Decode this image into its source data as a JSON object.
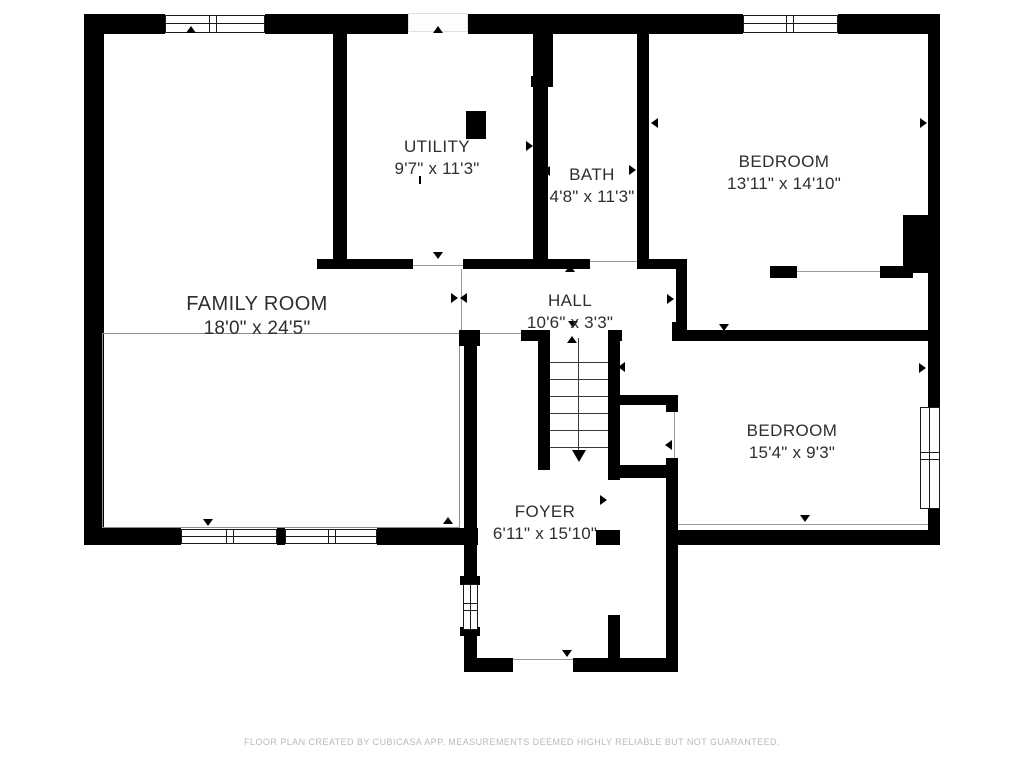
{
  "floorplan": {
    "rooms": [
      {
        "id": "utility",
        "label": "UTILITY",
        "dims": "9'7\" x 11'3\""
      },
      {
        "id": "bath",
        "label": "BATH",
        "dims": "4'8\" x 11'3\""
      },
      {
        "id": "bedroom1",
        "label": "BEDROOM",
        "dims": "13'11\" x 14'10\""
      },
      {
        "id": "family",
        "label": "FAMILY ROOM",
        "dims": "18'0\" x 24'5\""
      },
      {
        "id": "hall",
        "label": "HALL",
        "dims": "10'6\" x 3'3\""
      },
      {
        "id": "bedroom2",
        "label": "BEDROOM",
        "dims": "15'4\" x 9'3\""
      },
      {
        "id": "foyer",
        "label": "FOYER",
        "dims": "6'11\" x 15'10\""
      }
    ],
    "footer": "FLOOR PLAN CREATED BY CUBICASA APP. MEASUREMENTS DEEMED HIGHLY RELIABLE BUT NOT GUARANTEED.",
    "colors": {
      "wall": "#000000",
      "text": "#2e2e2e",
      "footer": "#b9b9b9",
      "thin_line": "#9a9a9a"
    }
  }
}
